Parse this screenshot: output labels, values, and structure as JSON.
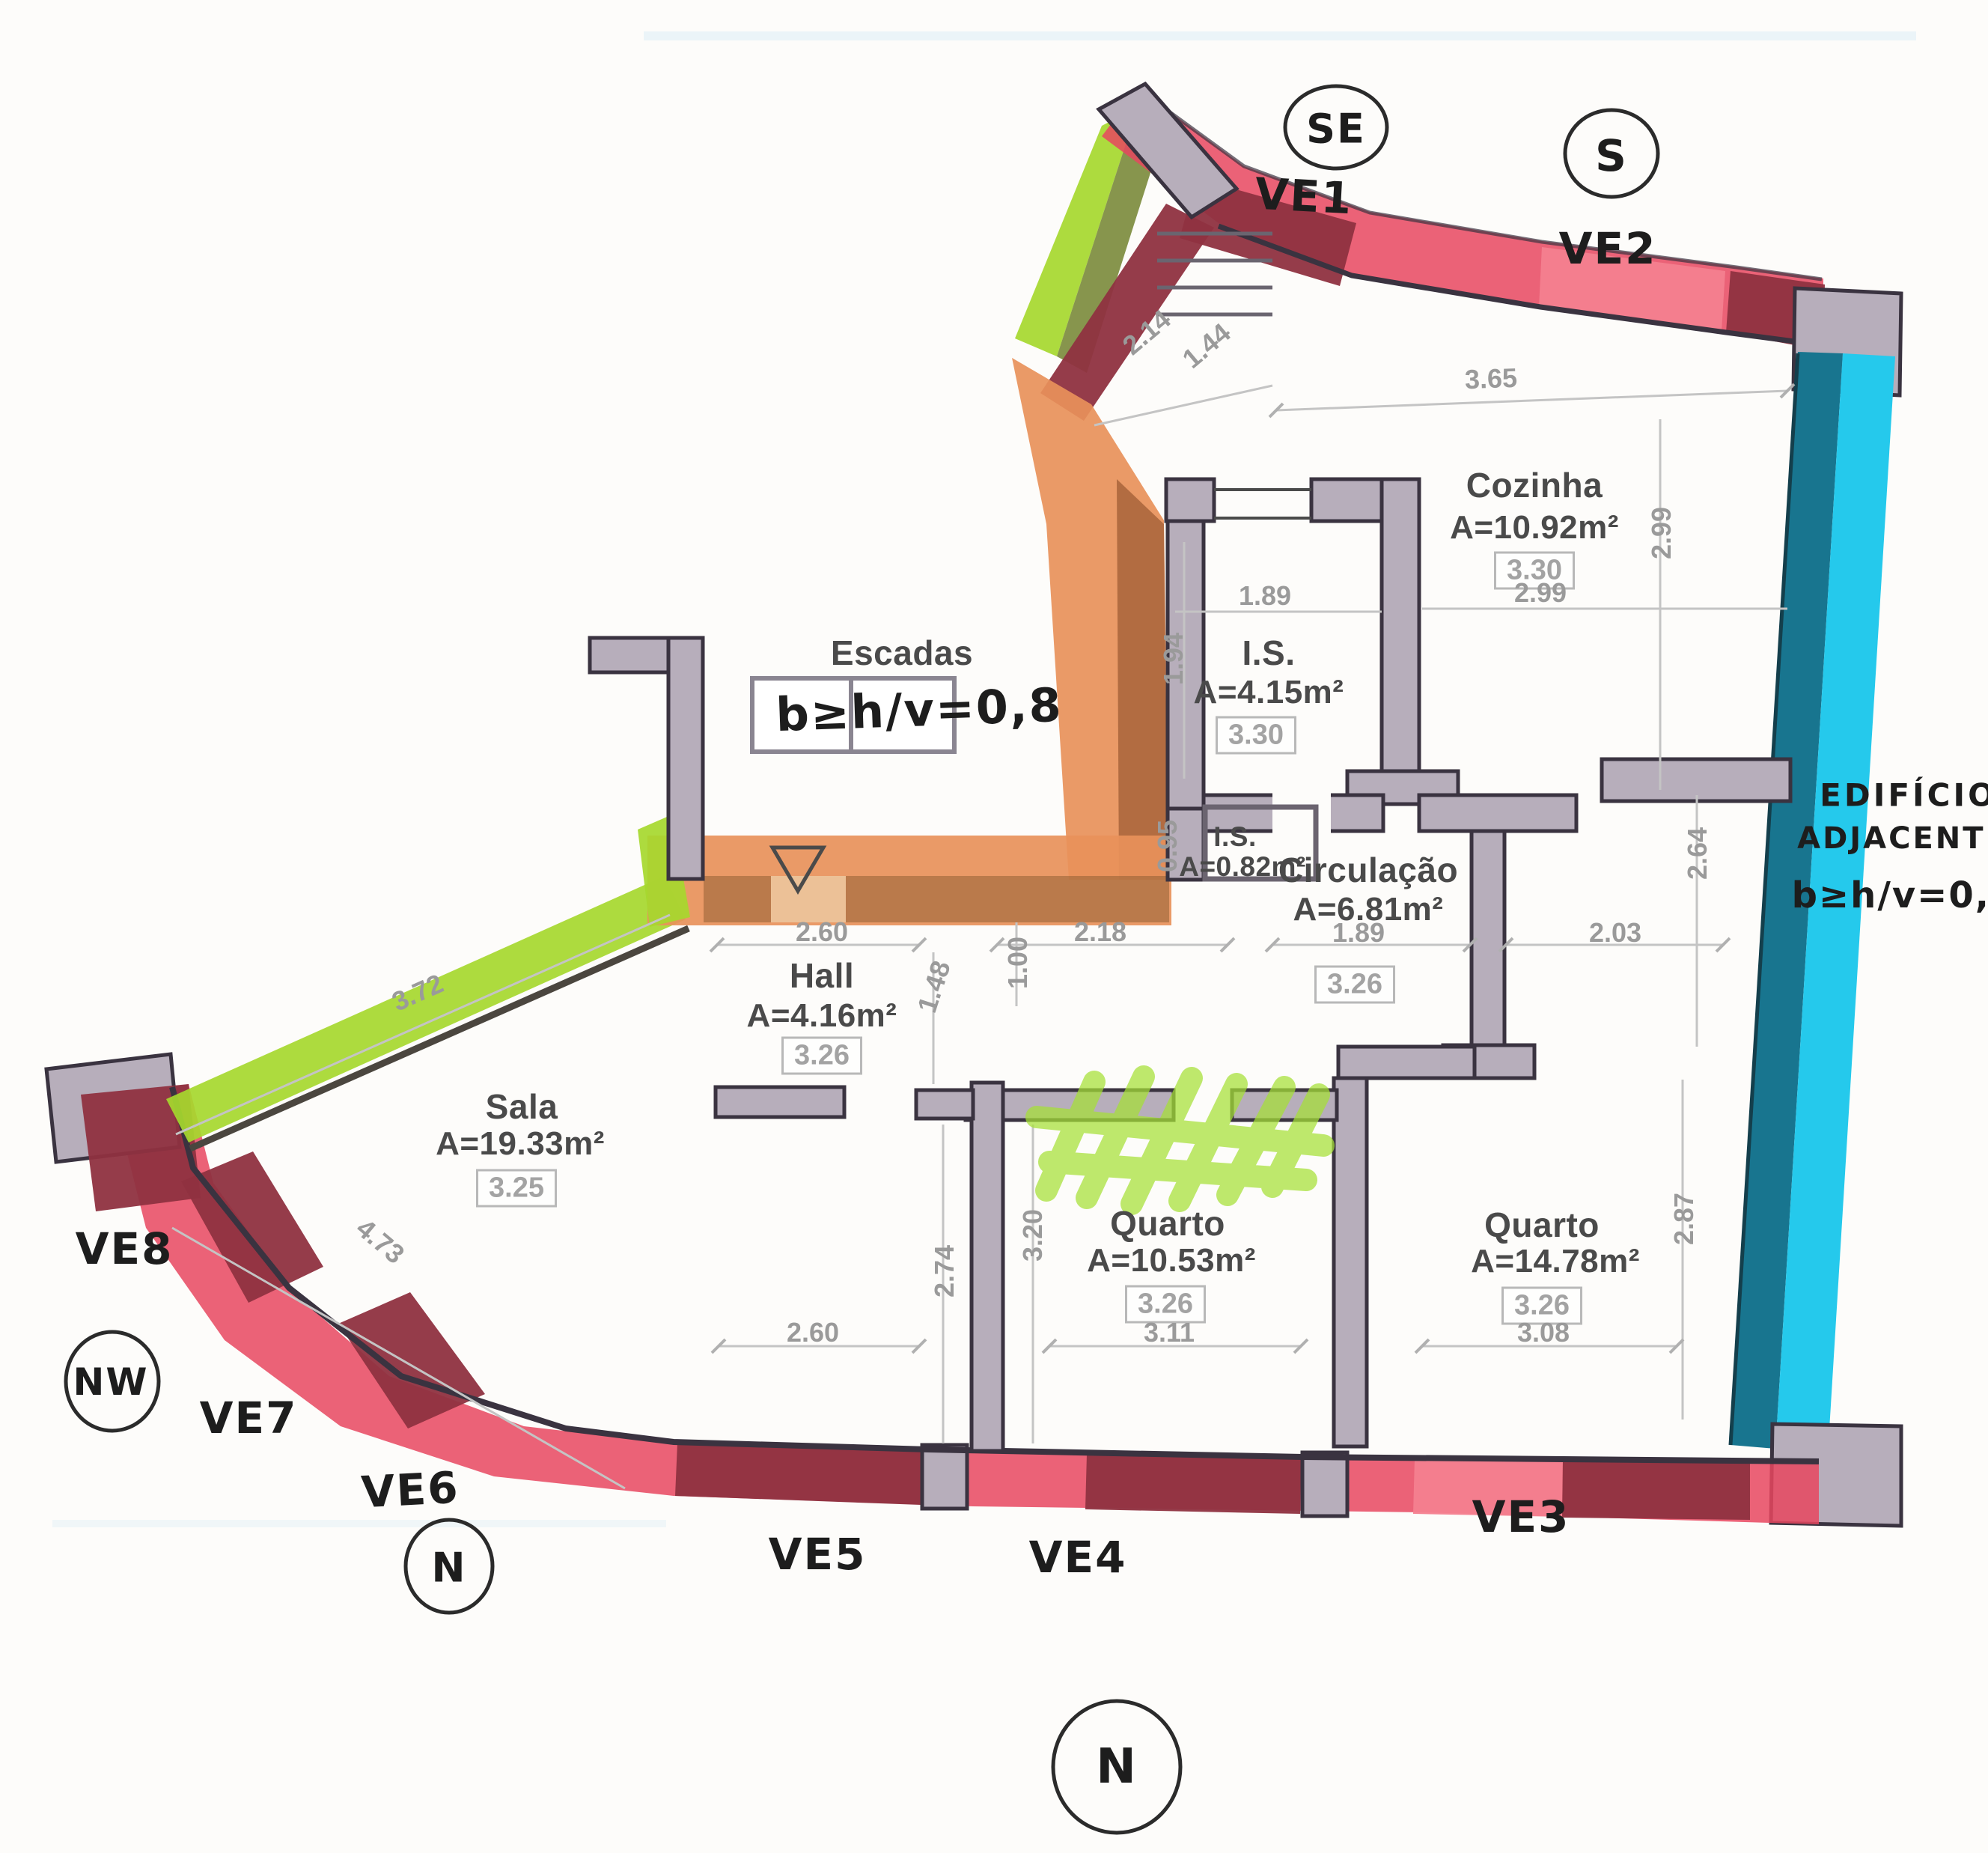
{
  "title": "Apartment floor plan with daylight study annotations",
  "colors": {
    "facade_red": "#e8465f",
    "facade_pink": "#f4808f",
    "window_maroon": "#8f3140",
    "wall_gray": "#b7aebb",
    "wall_outline": "#3a3340",
    "highlight_green": "#a6d82e",
    "highlight_olive": "#7d8c3e",
    "highlight_orange": "#e8915a",
    "highlight_brown": "#9c5a33",
    "adjacent_teal": "#18758f",
    "adjacent_cyan": "#25c9ec",
    "scribble_green": "#a5e034",
    "ink": "#1d1d1d",
    "print_dark": "#4a4a4a",
    "print_light": "#9a9a9a"
  },
  "plan": {
    "rooms": [
      {
        "name": "Cozinha",
        "area": "A=10.92m²",
        "box": "3.30"
      },
      {
        "name": "I.S.",
        "area": "A=4.15m²",
        "box": "3.30"
      },
      {
        "name": "I.S.",
        "area": "A=0.82m²"
      },
      {
        "name": "Circulação",
        "area": "A=6.81m²",
        "box": "3.26"
      },
      {
        "name": "Hall",
        "area": "A=4.16m²",
        "box": "3.26"
      },
      {
        "name": "Sala",
        "area": "A=19.33m²",
        "box": "3.25"
      },
      {
        "name": "Quarto",
        "area": "A=10.53m²",
        "box": "3.26"
      },
      {
        "name": "Quarto",
        "area": "A=14.78m²",
        "box": "3.26"
      },
      {
        "name": "Escadas"
      }
    ],
    "dims": {
      "top_diag_a": "2.14",
      "top_diag_b": "1.44",
      "coz_top": "3.65",
      "coz_right": "2.99",
      "coz_bottom": "2.99",
      "is_top": "1.89",
      "is_left": "1.94",
      "is2_left": "0.95",
      "circ_w": "1.89",
      "circ_e": "2.03",
      "circ_v": "2.64",
      "hall_top": "2.60",
      "corridor": "2.18",
      "hall_v1": "1.48",
      "hall_v2": "1.00",
      "sala_diag_a": "3.72",
      "sala_diag_b": "4.73",
      "sala_w": "2.60",
      "q1_v1": "2.74",
      "q1_v2": "3.20",
      "q1_w": "3.11",
      "q2_w": "3.08",
      "q2_v": "2.87"
    }
  },
  "annotations": {
    "escadas_note": "b≥h/v=0,8",
    "adjacent_line1": "EDIFÍCIO",
    "adjacent_line2": "ADJACENTE",
    "adjacent_note": "b≥h/v=0,6",
    "compass": {
      "se": "SE",
      "s": "S",
      "nw": "NW",
      "n_small": "N",
      "n_big": "N"
    },
    "windows": [
      "VE1",
      "VE2",
      "VE3",
      "VE4",
      "VE5",
      "VE6",
      "VE7",
      "VE8"
    ]
  }
}
